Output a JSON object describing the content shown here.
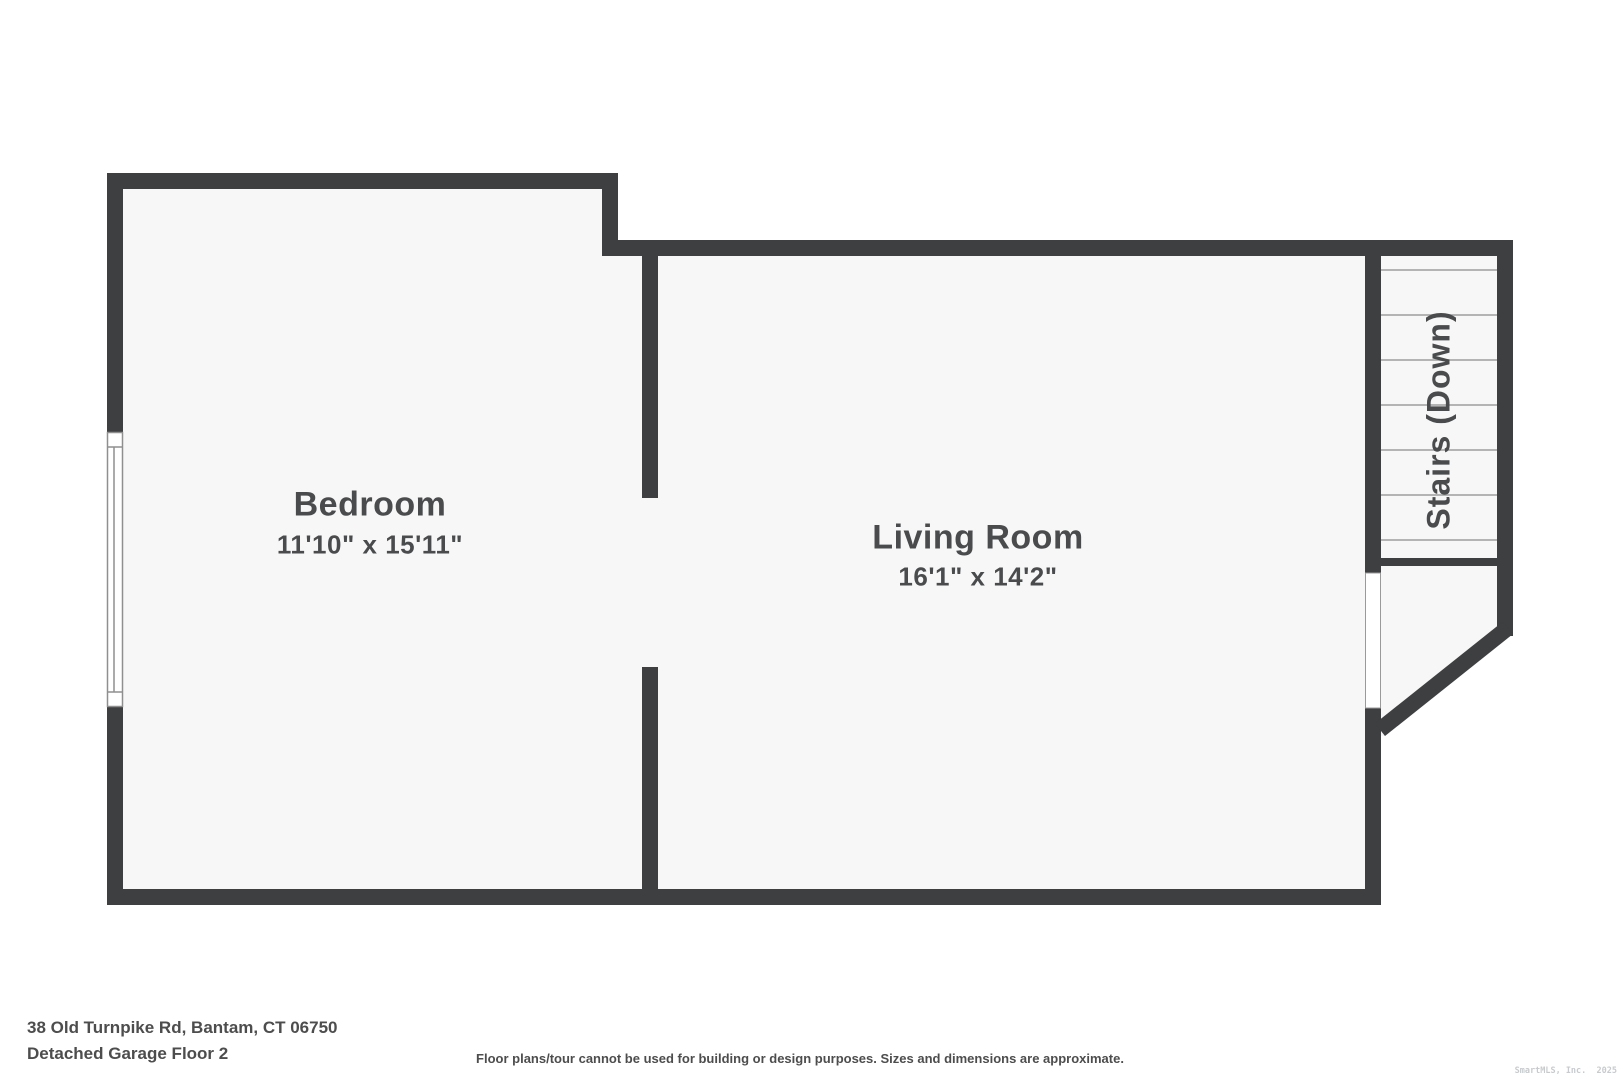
{
  "plan": {
    "rooms": [
      {
        "name": "Bedroom",
        "dims": "11'10\" x 15'11\""
      },
      {
        "name": "Living Room",
        "dims": "16'1\" x 14'2\""
      }
    ],
    "stairs_label": "Stairs (Down)"
  },
  "footer": {
    "address": "38 Old Turnpike Rd, Bantam, CT 06750",
    "floor_label": "Detached Garage Floor 2",
    "disclaimer": "Floor plans/tour cannot be used for building or design purposes. Sizes and dimensions are approximate.",
    "watermark": "SmartMLS, Inc.  2025"
  },
  "colors": {
    "wall": "#3e3f41",
    "floor": "#f7f7f8",
    "step_line": "#b4b4b4",
    "window_line": "#8f8f8f",
    "label_text": "#494b4d",
    "footer_text": "#4d4d4d",
    "watermark_text": "#c8cbce"
  }
}
